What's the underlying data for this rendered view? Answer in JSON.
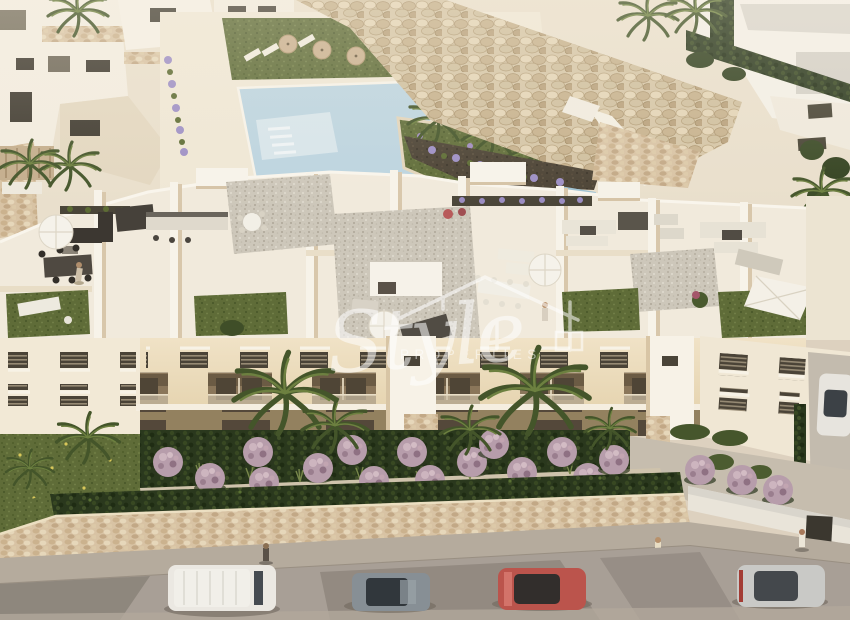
{
  "watermark": {
    "brand_script": "Style",
    "brand_caps": "PROPERTIES",
    "logo_icon": "house-roof-outline-icon",
    "color": "#ffffff",
    "opacity": 0.55
  },
  "scene": {
    "type": "aerial-3d-architectural-render",
    "subject": "new-build apartment complex with rooftop solarium terraces, communal pool, landscaped gardens and street parking",
    "lighting": "warm golden-hour sunlight",
    "palette": {
      "building_white": "#f1eadc",
      "facade_warm": "#eee0c2",
      "wall_shadow": "#d8c7ab",
      "pool_blue": "#bcd4e0",
      "lawn_green": "#5f6c38",
      "hedge_green": "#2a381d",
      "palm_green": "#44552a",
      "stone_beige": "#d8c3a4",
      "street_grey": "#a89f96",
      "sidewalk_grey": "#b5ab9d",
      "shrub_pink": "#b79dab",
      "soil_brown": "#4b4234"
    },
    "vehicles": [
      {
        "kind": "van",
        "color_name": "white",
        "hex": "#ebe8e2"
      },
      {
        "kind": "suv",
        "color_name": "grey",
        "hex": "#878f95"
      },
      {
        "kind": "car",
        "color_name": "red",
        "hex": "#bb544c"
      },
      {
        "kind": "car",
        "color_name": "silver",
        "hex": "#c9c9c6"
      },
      {
        "kind": "car",
        "color_name": "white",
        "hex": "#e7e4de"
      }
    ],
    "features": [
      "communal-swimming-pool",
      "rock-rip-rap-slope",
      "rooftop-terraces-with-furniture",
      "white-parasols",
      "sun-loungers",
      "artificial-lawn-patches",
      "palm-trees",
      "purple-flowering-shrubs",
      "stone-retaining-wall",
      "hedge-above-wall",
      "pedestrians-on-sidewalk",
      "street-parking"
    ]
  }
}
